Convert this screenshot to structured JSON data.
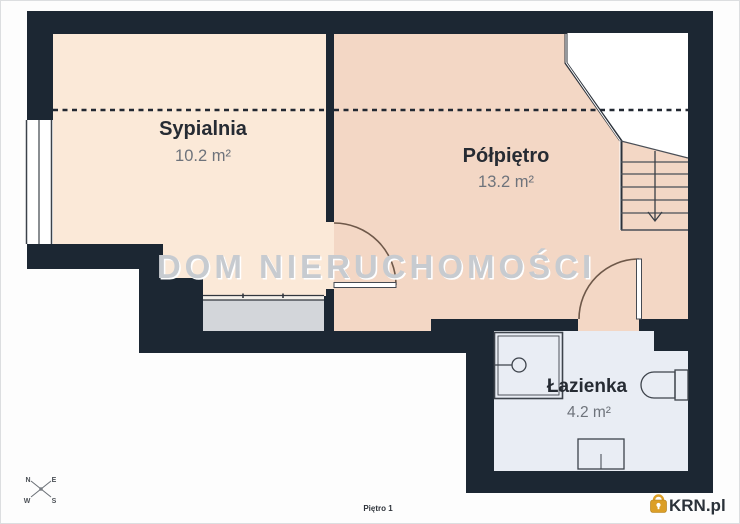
{
  "floorplan": {
    "watermark": "DOM NIERUCHOMOŚCI",
    "floor_label": "Piętro 1",
    "rooms": [
      {
        "name": "Sypialnia",
        "area": "10.2 m²"
      },
      {
        "name": "Półpiętro",
        "area": "13.2 m²"
      },
      {
        "name": "Łazienka",
        "area": "4.2 m²"
      }
    ],
    "compass": {
      "n": "N",
      "e": "E",
      "w": "W",
      "s": "S"
    },
    "branding": {
      "logo_text": "KRN.pl"
    },
    "colors": {
      "wall": "#1c2733",
      "bedroom_fill": "#fbe9d8",
      "halffloor_fill": "#f3d7c5",
      "bathroom_fill": "#e9edf4",
      "wardrobe_fill": "#d3d6da",
      "watermark_gray": "#c7cbd0",
      "logo_gold": "#dc9f27"
    }
  }
}
